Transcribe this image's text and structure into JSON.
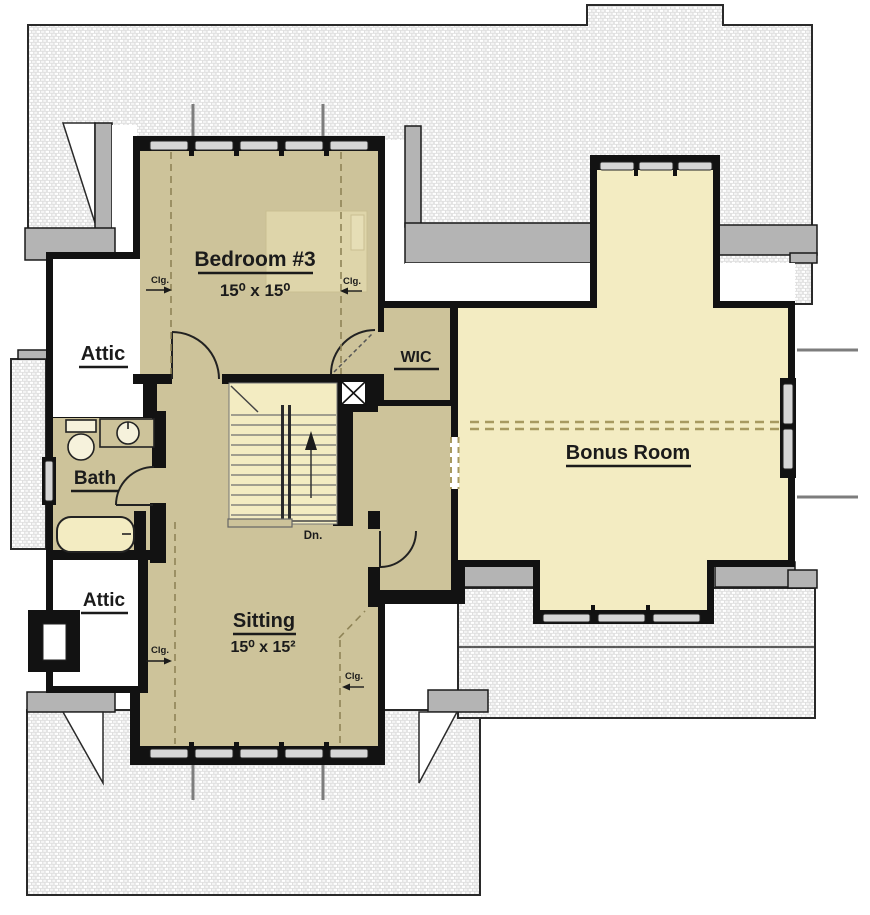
{
  "plan": {
    "rooms": {
      "bedroom3": {
        "name": "Bedroom #3",
        "dims": "15⁰ x 15⁰"
      },
      "attic_upper": {
        "name": "Attic"
      },
      "bath": {
        "name": "Bath"
      },
      "attic_lower": {
        "name": "Attic"
      },
      "wic": {
        "name": "WIC"
      },
      "bonus": {
        "name": "Bonus Room"
      },
      "sitting": {
        "name": "Sitting",
        "dims": "15⁰ x 15²"
      }
    },
    "annotations": {
      "down": "Dn.",
      "clg": "Clg."
    },
    "colors": {
      "floor_tan": "#cdc39a",
      "floor_cream": "#f3ecc2",
      "wall": "#121212",
      "roof_gray": "#e0e0e0",
      "trim_gray": "#b4b4b4"
    }
  }
}
